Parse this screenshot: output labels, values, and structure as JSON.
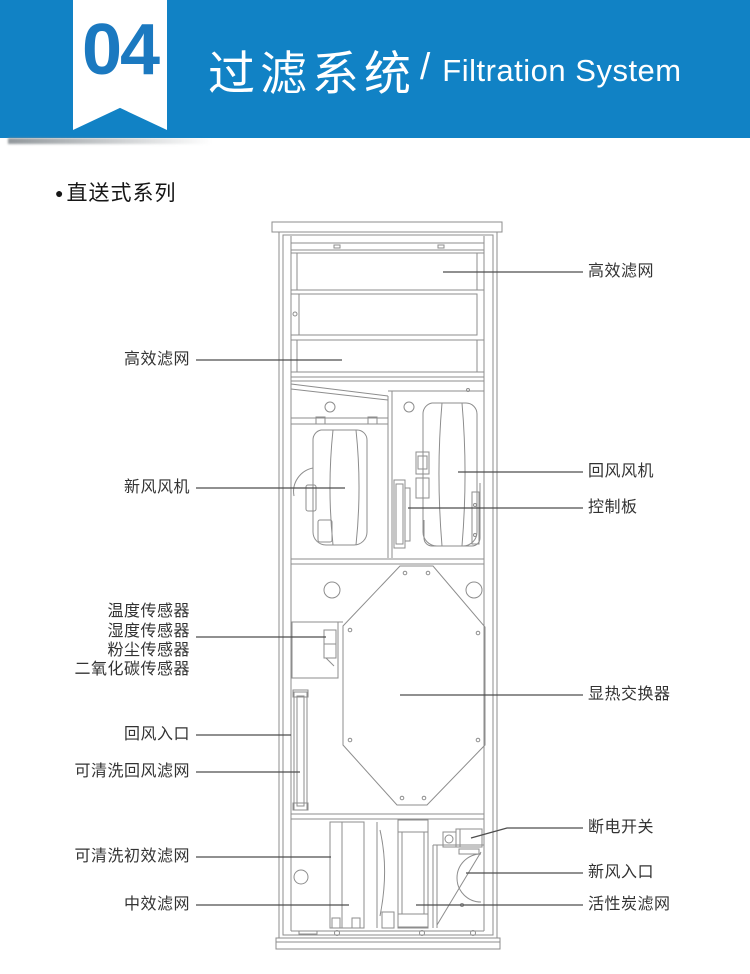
{
  "page": {
    "background": "#ffffff"
  },
  "header": {
    "badge_number": "04",
    "title_cn": "过滤系统",
    "separator": "/",
    "title_en": "Filtration System",
    "colors": {
      "banner_bg": "#1182c5",
      "badge_bg": "#ffffff",
      "badge_text": "#1b79c0",
      "title_text": "#ffffff"
    }
  },
  "section": {
    "bullet": "●",
    "series_title": "直送式系列"
  },
  "diagram": {
    "labels_left": [
      "高效滤网",
      "新风风机",
      "温度传感器",
      "湿度传感器",
      "粉尘传感器",
      "二氧化碳传感器",
      "回风入口",
      "可清洗回风滤网",
      "可清洗初效滤网",
      "中效滤网"
    ],
    "labels_right": [
      "高效滤网",
      "回风风机",
      "控制板",
      "显热交换器",
      "断电开关",
      "新风入口",
      "活性炭滤网"
    ],
    "colors": {
      "line": "#8d8d8d",
      "leader": "#4d4d4d",
      "label_text": "#333333"
    }
  }
}
